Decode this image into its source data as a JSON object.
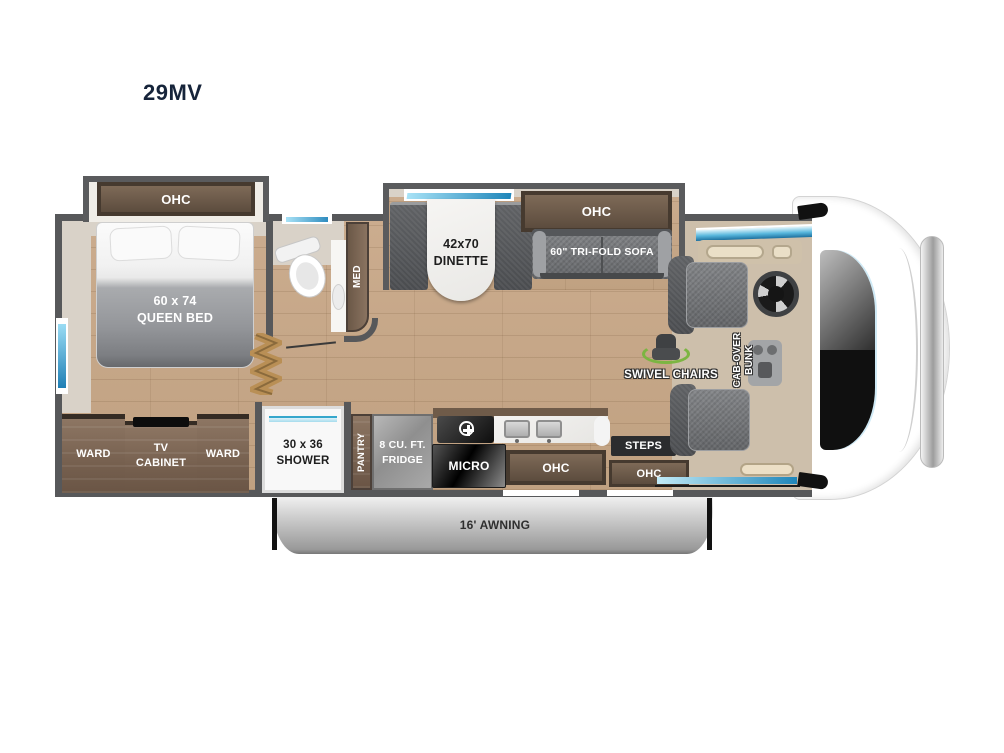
{
  "title": "29MV",
  "bedroom": {
    "ohc": "OHC",
    "bed_size": "60 x 74",
    "bed_name": "QUEEN BED",
    "ward_left": "WARD",
    "tv_line1": "TV",
    "tv_line2": "CABINET",
    "ward_right": "WARD"
  },
  "bathroom": {
    "med": "MED",
    "shower_size": "30 x 36",
    "shower_name": "SHOWER"
  },
  "kitchen": {
    "pantry": "PANTRY",
    "fridge_line1": "8 CU. FT.",
    "fridge_line2": "FRIDGE",
    "micro": "MICRO",
    "ohc": "OHC"
  },
  "living": {
    "dinette_size": "42x70",
    "dinette_name": "DINETTE",
    "sofa_ohc": "OHC",
    "sofa": "60\" TRI-FOLD SOFA",
    "swivel": "SWIVEL CHAIRS",
    "cabover_line1": "CAB-OVER",
    "cabover_line2": "BUNK"
  },
  "entry": {
    "steps": "STEPS",
    "ohc": "OHC"
  },
  "exterior": {
    "awning": "16' AWNING"
  },
  "colors": {
    "wall": "#57585a",
    "wood_floor": "#c4a487",
    "cabinet_wood": "#7b6553",
    "ohc_frame": "#46392e",
    "window_blue": "#2f8cbf",
    "accent_green": "#7cb542",
    "furniture_gray": "#7d7f82",
    "awning_silver": "#b9b9b9",
    "title_navy": "#1d2a39"
  }
}
